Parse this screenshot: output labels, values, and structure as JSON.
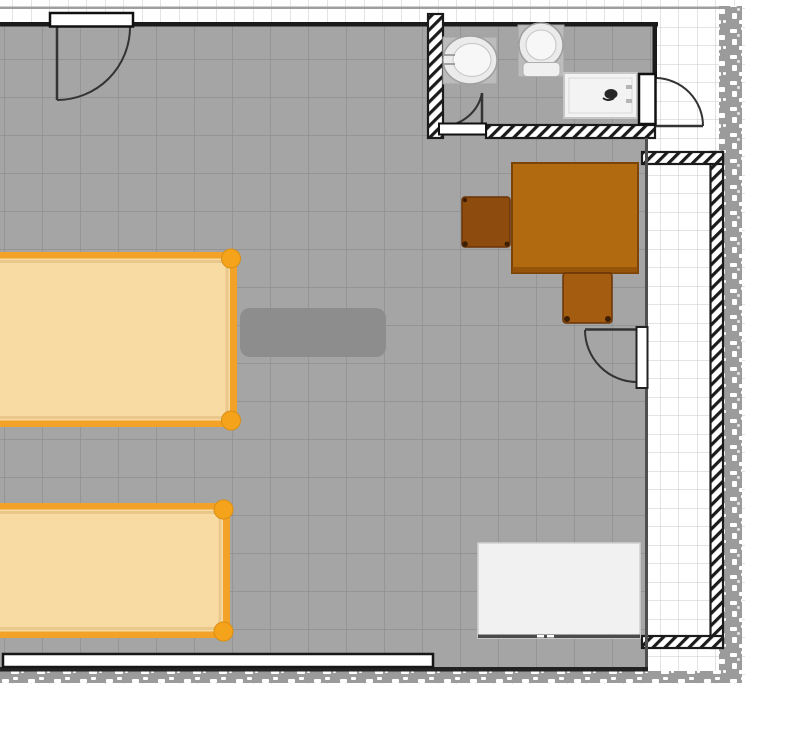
{
  "palette": {
    "page_bg": "#ffffff",
    "outside_grid_line": "#c9c9c9",
    "outer_top_line": "#9f9f9f",
    "floor": "#a5a5a5",
    "floor_grid_line": "#8e8e8e",
    "wall_outline": "#1b1b1b",
    "wall_fill": "#ffffff",
    "rubble": "#9b9b9b",
    "rubble_speckle": "#ffffff",
    "divider": "#4f4f4f",
    "room_edge": "#222222",
    "door_line": "#333333",
    "door_leaf": "#ffffff",
    "window_fill": "#ffffff",
    "window_border": "#161616",
    "bed_frame": "#f2a227",
    "bed_fill": "#f8dba2",
    "bed_inner": "#eac78b",
    "bed_knob": "#f6a31c",
    "rug": "#8d8d8d",
    "desk": "#b26a10",
    "desk_edge": "#7c4306",
    "chair_left": "#8d4b0d",
    "chair_bottom": "#a45c10",
    "chair_foot": "#3c1e02",
    "dresser": "#f1f1f1",
    "dresser_edge": "#4a4a4a",
    "fixture_pad": "#bcbcbc",
    "fixture_pad_edge": "#a2a2a2",
    "fixture_bowl": "#ebebeb",
    "fixture_bowl_inner": "#f7f7f7",
    "fixture_ring": "#9f9f9f",
    "shower_tray": "#f3f3f3",
    "shower_edge": "#c6c6c6",
    "drain": "#272727"
  },
  "plan": {
    "rooms": [
      {
        "name": "main-room",
        "floor": "gray-tile"
      },
      {
        "name": "bathroom",
        "floor": "gray-tile"
      },
      {
        "name": "corridor",
        "floor": "white-tile"
      }
    ],
    "furniture": [
      {
        "name": "bed-top",
        "kind": "bed"
      },
      {
        "name": "bed-bottom",
        "kind": "bed"
      },
      {
        "name": "rug",
        "kind": "rug"
      },
      {
        "name": "desk",
        "kind": "desk"
      },
      {
        "name": "chair-left",
        "kind": "chair"
      },
      {
        "name": "chair-bottom",
        "kind": "chair"
      },
      {
        "name": "dresser",
        "kind": "dresser"
      }
    ],
    "fixtures": [
      {
        "name": "washbasin",
        "kind": "washbasin"
      },
      {
        "name": "toilet",
        "kind": "toilet"
      },
      {
        "name": "shower",
        "kind": "shower-tray"
      }
    ],
    "doors": [
      {
        "name": "door-top"
      },
      {
        "name": "door-bathroom-inner"
      },
      {
        "name": "door-bathroom-right"
      },
      {
        "name": "door-room-right"
      }
    ],
    "windows": [
      {
        "name": "window-bottom"
      }
    ]
  }
}
